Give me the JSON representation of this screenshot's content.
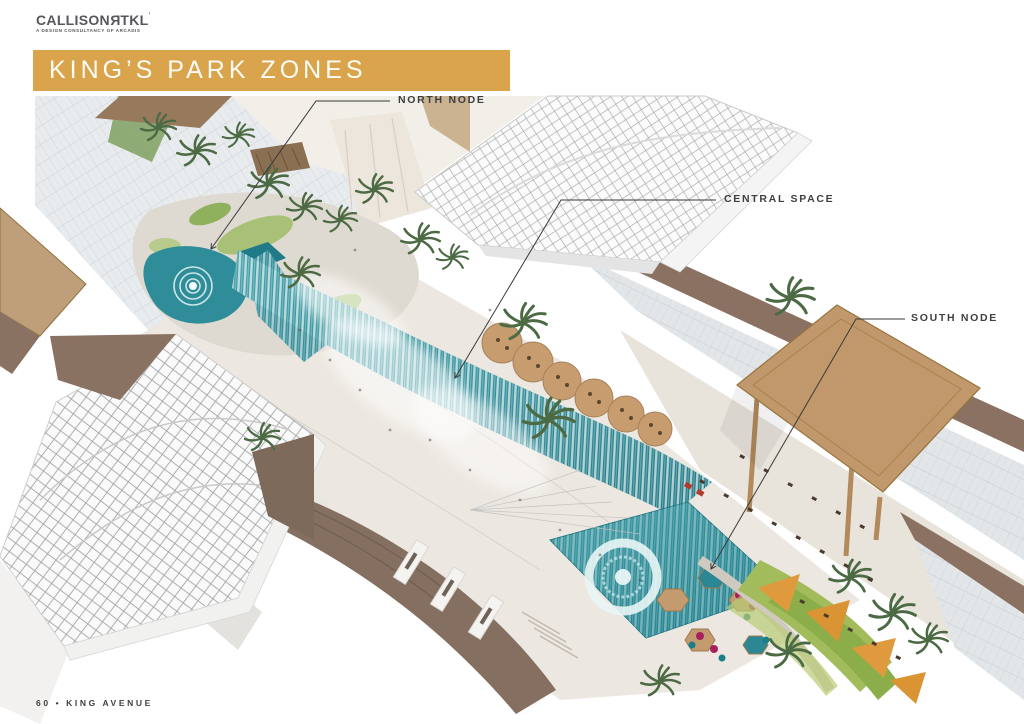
{
  "header": {
    "logo": {
      "text_main": "CALLISON",
      "text_reversed": "R",
      "text_tail": "TKL",
      "trademark": "’",
      "tagline": "A DESIGN CONSULTANCY OF ARCADIS"
    },
    "title": "KING’S PARK ZONES"
  },
  "annotations": [
    {
      "id": "north-node",
      "label": "NORTH NODE"
    },
    {
      "id": "central-space",
      "label": "CENTRAL SPACE"
    },
    {
      "id": "south-node",
      "label": "SOUTH NODE"
    }
  ],
  "footer": {
    "page_label": "60 • KING AVENUE"
  },
  "colors": {
    "accent_gold": "#D9A44B",
    "label_text": "#3E3F41",
    "logo_gray": "#56575B",
    "pool_teal": "#2F8D99",
    "canopy_tan": "#C0986B",
    "roof_brown": "#8A7161",
    "lawn_green": "#A3BC5B",
    "shade_orange": "#E09A3E"
  }
}
